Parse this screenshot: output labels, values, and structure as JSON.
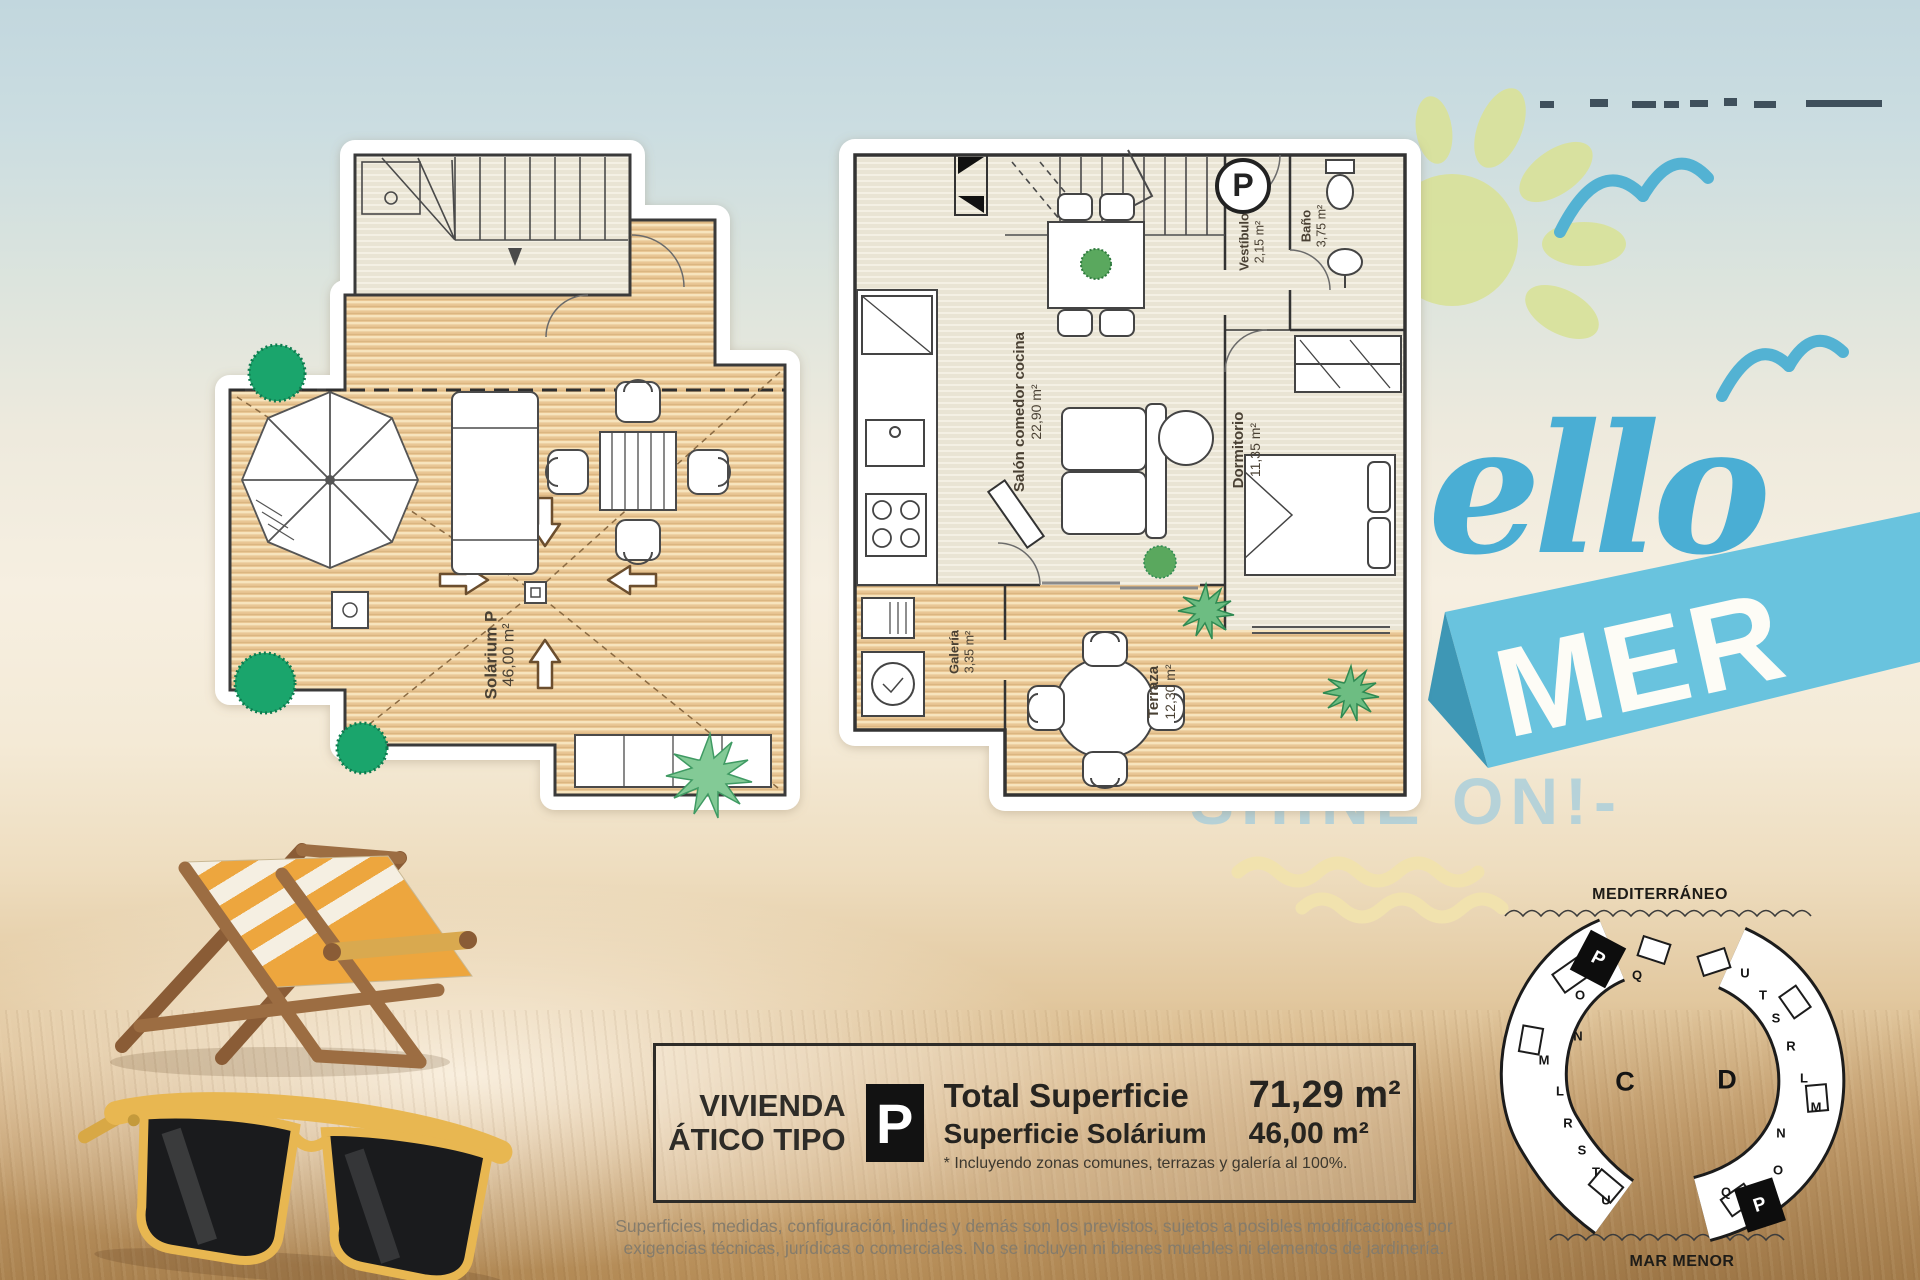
{
  "branding": {
    "script_text": "ello",
    "banner_text": "MER",
    "tagline": "SHINE ON!-",
    "colors": {
      "script_blue": "#4aaed4",
      "banner_blue": "#69c3de",
      "tagline_blue": "#accfdb",
      "sun_green": "#d9e29c",
      "wave_yellow": "#f1e2ae"
    }
  },
  "plan_solarium": {
    "room_label": "Solárium P",
    "room_area": "46,00 m²"
  },
  "plan_apartment": {
    "parking_symbol": "P",
    "rooms": [
      {
        "label": "Salón comedor cocina",
        "area": "22,90 m²"
      },
      {
        "label": "Vestíbulo",
        "area": "2,15 m²"
      },
      {
        "label": "Baño",
        "area": "3,75 m²"
      },
      {
        "label": "Dormitorio",
        "area": "11,35 m²"
      },
      {
        "label": "Galería",
        "area": "3,35 m²"
      },
      {
        "label": "Terraza",
        "area": "12,30 m²"
      }
    ]
  },
  "info_box": {
    "title_line1": "VIVIENDA",
    "title_line2": "ÁTICO TIPO",
    "type_badge": "P",
    "total_label": "Total Superficie",
    "total_value": "71,29 m²",
    "solarium_label": "Superficie Solárium",
    "solarium_value": "46,00 m²",
    "note": "* Incluyendo zonas comunes, terrazas y galería al 100%."
  },
  "disclaimer_line1": "Superficies, medidas, configuración, lindes y demás son los previstos, sujetos a posibles modificaciones por",
  "disclaimer_line2": "exigencias técnicas, jurídicas o comerciales. No se incluyen ni bienes muebles ni elementos de jardinería.",
  "site_map": {
    "sea_label": "MEDITERRÁNEO",
    "lagoon_label": "MAR MENOR",
    "block_c": {
      "name": "C",
      "units": [
        "P",
        "Q",
        "O",
        "N",
        "M",
        "L",
        "R",
        "S",
        "T",
        "U"
      ],
      "highlighted_unit": "P"
    },
    "block_d": {
      "name": "D",
      "units": [
        "U",
        "T",
        "S",
        "R",
        "L",
        "M",
        "N",
        "O",
        "Q",
        "P"
      ],
      "highlighted_unit": "P"
    }
  }
}
